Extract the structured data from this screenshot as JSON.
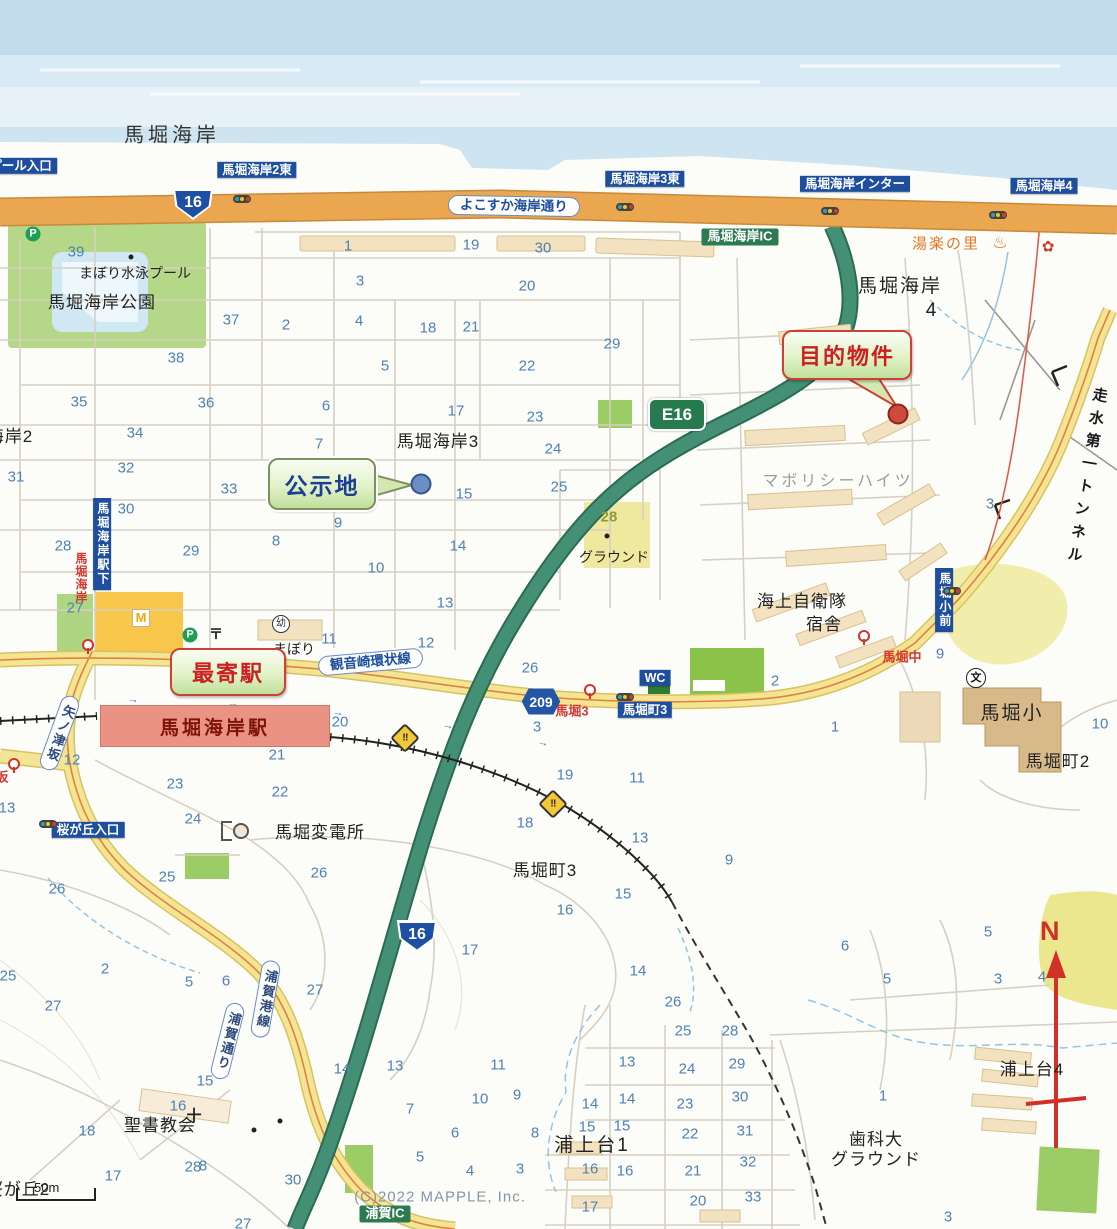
{
  "map": {
    "copyright": "(C)2022 MAPPLE, Inc.",
    "scale_label": "50m",
    "compass_label": "N"
  },
  "callouts": {
    "target": {
      "label": "目的物件"
    },
    "kojichi": {
      "label": "公示地"
    },
    "nearest": {
      "label": "最寄駅"
    }
  },
  "station": {
    "name": "馬堀海岸駅"
  },
  "badges": {
    "route16_top": "16",
    "route16_south": "16",
    "e16": "E16",
    "k209": "209"
  },
  "labels": [
    {
      "t": "馬堀海岸",
      "x": 172,
      "y": 136,
      "cls": "sea-lbl"
    },
    {
      "t": "市営プール入口",
      "x": 8,
      "y": 166,
      "cls": "bsign",
      "tl": 1
    },
    {
      "t": "馬堀海岸2東",
      "x": 257,
      "y": 170,
      "cls": "bsign",
      "tl": 1
    },
    {
      "t": "馬堀海岸3東",
      "x": 645,
      "y": 179,
      "cls": "bsign",
      "tl": 1
    },
    {
      "t": "馬堀海岸インター",
      "x": 855,
      "y": 184,
      "cls": "bsign",
      "tl": 1
    },
    {
      "t": "馬堀海岸4",
      "x": 1044,
      "y": 186,
      "cls": "bsign",
      "tl": 1
    },
    {
      "t": "よこすか海岸通り",
      "x": 448,
      "y": 196,
      "cls": "banner",
      "tl": 1,
      "rot": 1
    },
    {
      "t": "馬堀海岸IC",
      "x": 740,
      "y": 237,
      "cls": "gsign",
      "tl": 1
    },
    {
      "t": "湯楽の里",
      "x": 946,
      "y": 244,
      "cls": "onsen-txt",
      "tl": 1
    },
    {
      "t": "馬堀海岸",
      "x": 900,
      "y": 287,
      "cls": "area-big"
    },
    {
      "t": "4",
      "x": 932,
      "y": 311,
      "cls": "area-big"
    },
    {
      "t": "まぼり水泳プール",
      "x": 135,
      "y": 273,
      "cls": "area-sm"
    },
    {
      "t": "馬堀海岸公園",
      "x": 102,
      "y": 303,
      "cls": "area"
    },
    {
      "t": "馬堀海岸2",
      "x": -8,
      "y": 437,
      "cls": "area"
    },
    {
      "t": "馬堀海岸3",
      "x": 438,
      "y": 442,
      "cls": "area"
    },
    {
      "t": "マボリシーハイツ",
      "x": 838,
      "y": 482,
      "cls": "gray"
    },
    {
      "t": "グラウンド",
      "x": 614,
      "y": 557,
      "cls": "area-sm"
    },
    {
      "t": "海上自衛隊",
      "x": 802,
      "y": 602,
      "cls": "area"
    },
    {
      "t": "宿舎",
      "x": 824,
      "y": 625,
      "cls": "area"
    },
    {
      "t": "走水第一トンネル",
      "x": 1086,
      "y": 478,
      "cls": "tunnel",
      "rot": 9
    },
    {
      "t": "観音崎環状線",
      "x": 318,
      "y": 652,
      "cls": "banner",
      "tl": 1,
      "rot": -5
    },
    {
      "t": "まぼり",
      "x": 294,
      "y": 649,
      "cls": "area-sm"
    },
    {
      "t": "馬堀3",
      "x": 572,
      "y": 712,
      "cls": "rstop"
    },
    {
      "t": "馬堀町3",
      "x": 645,
      "y": 710,
      "cls": "bsign",
      "tl": 1
    },
    {
      "t": "WC",
      "x": 655,
      "y": 678,
      "cls": "bsign",
      "tl": 1
    },
    {
      "t": "馬堀中",
      "x": 902,
      "y": 658,
      "cls": "rstop"
    },
    {
      "t": "馬堀小前",
      "x": 944,
      "y": 600,
      "cls": "bsign-v",
      "tl": 1
    },
    {
      "t": "馬堀小",
      "x": 1012,
      "y": 714,
      "cls": "area-big"
    },
    {
      "t": "馬堀町2",
      "x": 1058,
      "y": 762,
      "cls": "area"
    },
    {
      "t": "馬堀海岸駅下",
      "x": 102,
      "y": 544,
      "cls": "bsign-v",
      "tl": 1
    },
    {
      "t": "馬堀海岸",
      "x": 80,
      "y": 578,
      "cls": "rstop-v",
      "tl": 1
    },
    {
      "t": "桜が丘入口",
      "x": 88,
      "y": 830,
      "cls": "bsign",
      "tl": 1
    },
    {
      "t": "馬堀変電所",
      "x": 320,
      "y": 833,
      "cls": "area"
    },
    {
      "t": "馬堀町3",
      "x": 545,
      "y": 871,
      "cls": "area"
    },
    {
      "t": "矢ノ津坂",
      "x": 50,
      "y": 694,
      "cls": "banner-v",
      "tl": 1,
      "rot": 20
    },
    {
      "t": "浦賀港線",
      "x": 256,
      "y": 960,
      "cls": "banner-v",
      "tl": 1,
      "rot": 10
    },
    {
      "t": "浦賀通り",
      "x": 218,
      "y": 1002,
      "cls": "banner-v",
      "tl": 1,
      "rot": 14
    },
    {
      "t": "聖書教会",
      "x": 160,
      "y": 1126,
      "cls": "area"
    },
    {
      "t": "浦上台1",
      "x": 592,
      "y": 1146,
      "cls": "area-big"
    },
    {
      "t": "浦上台4",
      "x": 1032,
      "y": 1070,
      "cls": "area"
    },
    {
      "t": "歯科大",
      "x": 876,
      "y": 1140,
      "cls": "area"
    },
    {
      "t": "グラウンド",
      "x": 876,
      "y": 1160,
      "cls": "area"
    },
    {
      "t": "桜が丘2",
      "x": 18,
      "y": 1190,
      "cls": "area"
    },
    {
      "t": "浦賀IC",
      "x": 385,
      "y": 1214,
      "cls": "gsign",
      "tl": 1
    },
    {
      "t": "坂",
      "x": 2,
      "y": 778,
      "cls": "rstop",
      "tl": 1
    },
    {
      "t": "(C)2022 MAPPLE, Inc.",
      "x": 440,
      "y": 1197,
      "cls": "copyright",
      "tl": 1
    }
  ],
  "numbers": [
    {
      "t": "39",
      "x": 76,
      "y": 252
    },
    {
      "t": "1",
      "x": 348,
      "y": 246
    },
    {
      "t": "19",
      "x": 471,
      "y": 245
    },
    {
      "t": "30",
      "x": 543,
      "y": 248
    },
    {
      "t": "3",
      "x": 360,
      "y": 281
    },
    {
      "t": "20",
      "x": 527,
      "y": 286
    },
    {
      "t": "2",
      "x": 286,
      "y": 325
    },
    {
      "t": "4",
      "x": 359,
      "y": 321
    },
    {
      "t": "18",
      "x": 428,
      "y": 328
    },
    {
      "t": "21",
      "x": 471,
      "y": 327
    },
    {
      "t": "29",
      "x": 612,
      "y": 344
    },
    {
      "t": "5",
      "x": 385,
      "y": 366
    },
    {
      "t": "22",
      "x": 527,
      "y": 366
    },
    {
      "t": "37",
      "x": 231,
      "y": 320
    },
    {
      "t": "38",
      "x": 176,
      "y": 358
    },
    {
      "t": "35",
      "x": 79,
      "y": 402
    },
    {
      "t": "36",
      "x": 206,
      "y": 403
    },
    {
      "t": "34",
      "x": 135,
      "y": 433
    },
    {
      "t": "31",
      "x": 16,
      "y": 477
    },
    {
      "t": "32",
      "x": 126,
      "y": 468
    },
    {
      "t": "33",
      "x": 229,
      "y": 489
    },
    {
      "t": "30",
      "x": 126,
      "y": 509
    },
    {
      "t": "28",
      "x": 63,
      "y": 546
    },
    {
      "t": "29",
      "x": 191,
      "y": 551
    },
    {
      "t": "27",
      "x": 75,
      "y": 608
    },
    {
      "t": "6",
      "x": 326,
      "y": 406
    },
    {
      "t": "17",
      "x": 456,
      "y": 411
    },
    {
      "t": "23",
      "x": 535,
      "y": 417
    },
    {
      "t": "7",
      "x": 319,
      "y": 444
    },
    {
      "t": "24",
      "x": 553,
      "y": 449
    },
    {
      "t": "25",
      "x": 559,
      "y": 487
    },
    {
      "t": "15",
      "x": 464,
      "y": 494
    },
    {
      "t": "9",
      "x": 338,
      "y": 523
    },
    {
      "t": "8",
      "x": 276,
      "y": 541
    },
    {
      "t": "14",
      "x": 458,
      "y": 546
    },
    {
      "t": "10",
      "x": 376,
      "y": 568
    },
    {
      "t": "13",
      "x": 445,
      "y": 603
    },
    {
      "t": "28",
      "x": 609,
      "y": 517,
      "cls": "numo"
    },
    {
      "t": "11",
      "x": 329,
      "y": 639
    },
    {
      "t": "12",
      "x": 426,
      "y": 643
    },
    {
      "t": "26",
      "x": 530,
      "y": 668
    },
    {
      "t": "3",
      "x": 537,
      "y": 727
    },
    {
      "t": "2",
      "x": 775,
      "y": 681
    },
    {
      "t": "1",
      "x": 835,
      "y": 727
    },
    {
      "t": "9",
      "x": 940,
      "y": 654
    },
    {
      "t": "10",
      "x": 1100,
      "y": 724
    },
    {
      "t": "19",
      "x": 565,
      "y": 775
    },
    {
      "t": "11",
      "x": 637,
      "y": 778
    },
    {
      "t": "20",
      "x": 340,
      "y": 722
    },
    {
      "t": "21",
      "x": 277,
      "y": 755
    },
    {
      "t": "12",
      "x": 72,
      "y": 760
    },
    {
      "t": "3",
      "x": 990,
      "y": 504
    },
    {
      "t": "13",
      "x": 7,
      "y": 808
    },
    {
      "t": "23",
      "x": 175,
      "y": 784
    },
    {
      "t": "22",
      "x": 280,
      "y": 792
    },
    {
      "t": "24",
      "x": 193,
      "y": 819
    },
    {
      "t": "25",
      "x": 167,
      "y": 877
    },
    {
      "t": "26",
      "x": 57,
      "y": 889
    },
    {
      "t": "26",
      "x": 319,
      "y": 873
    },
    {
      "t": "18",
      "x": 525,
      "y": 823
    },
    {
      "t": "13",
      "x": 640,
      "y": 838
    },
    {
      "t": "9",
      "x": 729,
      "y": 860
    },
    {
      "t": "15",
      "x": 623,
      "y": 894
    },
    {
      "t": "16",
      "x": 565,
      "y": 910
    },
    {
      "t": "17",
      "x": 470,
      "y": 950
    },
    {
      "t": "14",
      "x": 638,
      "y": 971
    },
    {
      "t": "2",
      "x": 105,
      "y": 969
    },
    {
      "t": "5",
      "x": 189,
      "y": 982
    },
    {
      "t": "6",
      "x": 226,
      "y": 981
    },
    {
      "t": "27",
      "x": 315,
      "y": 990
    },
    {
      "t": "25",
      "x": 8,
      "y": 976
    },
    {
      "t": "27",
      "x": 53,
      "y": 1006
    },
    {
      "t": "26",
      "x": 673,
      "y": 1002
    },
    {
      "t": "16",
      "x": 178,
      "y": 1106
    },
    {
      "t": "18",
      "x": 87,
      "y": 1131
    },
    {
      "t": "17",
      "x": 113,
      "y": 1176
    },
    {
      "t": "28",
      "x": 193,
      "y": 1167
    },
    {
      "t": "30",
      "x": 293,
      "y": 1180
    },
    {
      "t": "27",
      "x": 243,
      "y": 1224
    },
    {
      "t": "15",
      "x": 205,
      "y": 1081
    },
    {
      "t": "14",
      "x": 342,
      "y": 1069
    },
    {
      "t": "13",
      "x": 395,
      "y": 1066
    },
    {
      "t": "11",
      "x": 498,
      "y": 1065
    },
    {
      "t": "10",
      "x": 480,
      "y": 1099
    },
    {
      "t": "9",
      "x": 517,
      "y": 1095
    },
    {
      "t": "7",
      "x": 410,
      "y": 1109
    },
    {
      "t": "8",
      "x": 203,
      "y": 1166
    },
    {
      "t": "6",
      "x": 455,
      "y": 1133
    },
    {
      "t": "5",
      "x": 420,
      "y": 1157
    },
    {
      "t": "4",
      "x": 470,
      "y": 1171
    },
    {
      "t": "3",
      "x": 520,
      "y": 1169
    },
    {
      "t": "16",
      "x": 590,
      "y": 1169
    },
    {
      "t": "15",
      "x": 587,
      "y": 1127
    },
    {
      "t": "8",
      "x": 535,
      "y": 1133
    },
    {
      "t": "14",
      "x": 590,
      "y": 1104
    },
    {
      "t": "25",
      "x": 683,
      "y": 1031
    },
    {
      "t": "28",
      "x": 730,
      "y": 1031
    },
    {
      "t": "13",
      "x": 627,
      "y": 1062
    },
    {
      "t": "24",
      "x": 687,
      "y": 1069
    },
    {
      "t": "29",
      "x": 737,
      "y": 1064
    },
    {
      "t": "14",
      "x": 627,
      "y": 1099
    },
    {
      "t": "23",
      "x": 685,
      "y": 1104
    },
    {
      "t": "30",
      "x": 740,
      "y": 1097
    },
    {
      "t": "15",
      "x": 622,
      "y": 1126
    },
    {
      "t": "22",
      "x": 690,
      "y": 1134
    },
    {
      "t": "31",
      "x": 745,
      "y": 1131
    },
    {
      "t": "16",
      "x": 625,
      "y": 1171
    },
    {
      "t": "21",
      "x": 693,
      "y": 1171
    },
    {
      "t": "32",
      "x": 748,
      "y": 1162
    },
    {
      "t": "20",
      "x": 698,
      "y": 1201
    },
    {
      "t": "33",
      "x": 753,
      "y": 1197
    },
    {
      "t": "1",
      "x": 883,
      "y": 1096
    },
    {
      "t": "3",
      "x": 948,
      "y": 1217
    },
    {
      "t": "17",
      "x": 590,
      "y": 1207
    },
    {
      "t": "6",
      "x": 845,
      "y": 946
    },
    {
      "t": "5",
      "x": 887,
      "y": 979
    },
    {
      "t": "5",
      "x": 988,
      "y": 932
    },
    {
      "t": "3",
      "x": 998,
      "y": 979
    },
    {
      "t": "4",
      "x": 1042,
      "y": 977
    }
  ],
  "icons": [
    {
      "g": "P",
      "x": 33,
      "y": 234,
      "cls": "p-ic"
    },
    {
      "g": "P",
      "x": 190,
      "y": 635,
      "cls": "p-ic"
    },
    {
      "g": "〒",
      "x": 216,
      "y": 634,
      "cls": "post"
    },
    {
      "g": "M",
      "x": 141,
      "y": 618,
      "cls": "mcd"
    },
    {
      "g": "幼",
      "x": 281,
      "y": 624,
      "cls": "circ"
    },
    {
      "g": "文",
      "x": 976,
      "y": 678,
      "cls": "circ2"
    },
    {
      "g": "♨",
      "x": 1000,
      "y": 243,
      "cls": "onsen"
    },
    {
      "g": "✿",
      "x": 1048,
      "y": 247,
      "cls": "shell"
    },
    {
      "g": "十",
      "x": 194,
      "y": 1116,
      "cls": "church"
    },
    {
      "g": "‼",
      "x": 405,
      "y": 738,
      "cls": "xing",
      "rot": 45
    },
    {
      "g": "‼",
      "x": 553,
      "y": 804,
      "cls": "xing",
      "rot": 45
    },
    {
      "g": "→",
      "x": 133,
      "y": 700,
      "cls": "arr",
      "rot": 4
    },
    {
      "g": "→",
      "x": 233,
      "y": 704,
      "cls": "arr",
      "rot": 4
    },
    {
      "g": "→",
      "x": 338,
      "y": 713,
      "cls": "arr",
      "rot": 8
    },
    {
      "g": "→",
      "x": 448,
      "y": 726,
      "cls": "arr",
      "rot": 10
    },
    {
      "g": "→",
      "x": 543,
      "y": 743,
      "cls": "arr",
      "rot": 14
    }
  ],
  "traffic_lights": [
    {
      "x": 242,
      "y": 199
    },
    {
      "x": 625,
      "y": 207
    },
    {
      "x": 830,
      "y": 211
    },
    {
      "x": 998,
      "y": 215
    },
    {
      "x": 48,
      "y": 824
    },
    {
      "x": 625,
      "y": 697
    },
    {
      "x": 952,
      "y": 591
    }
  ],
  "bus_stops": [
    {
      "x": 88,
      "y": 645
    },
    {
      "x": 590,
      "y": 690
    },
    {
      "x": 864,
      "y": 636
    },
    {
      "x": 14,
      "y": 764
    }
  ]
}
